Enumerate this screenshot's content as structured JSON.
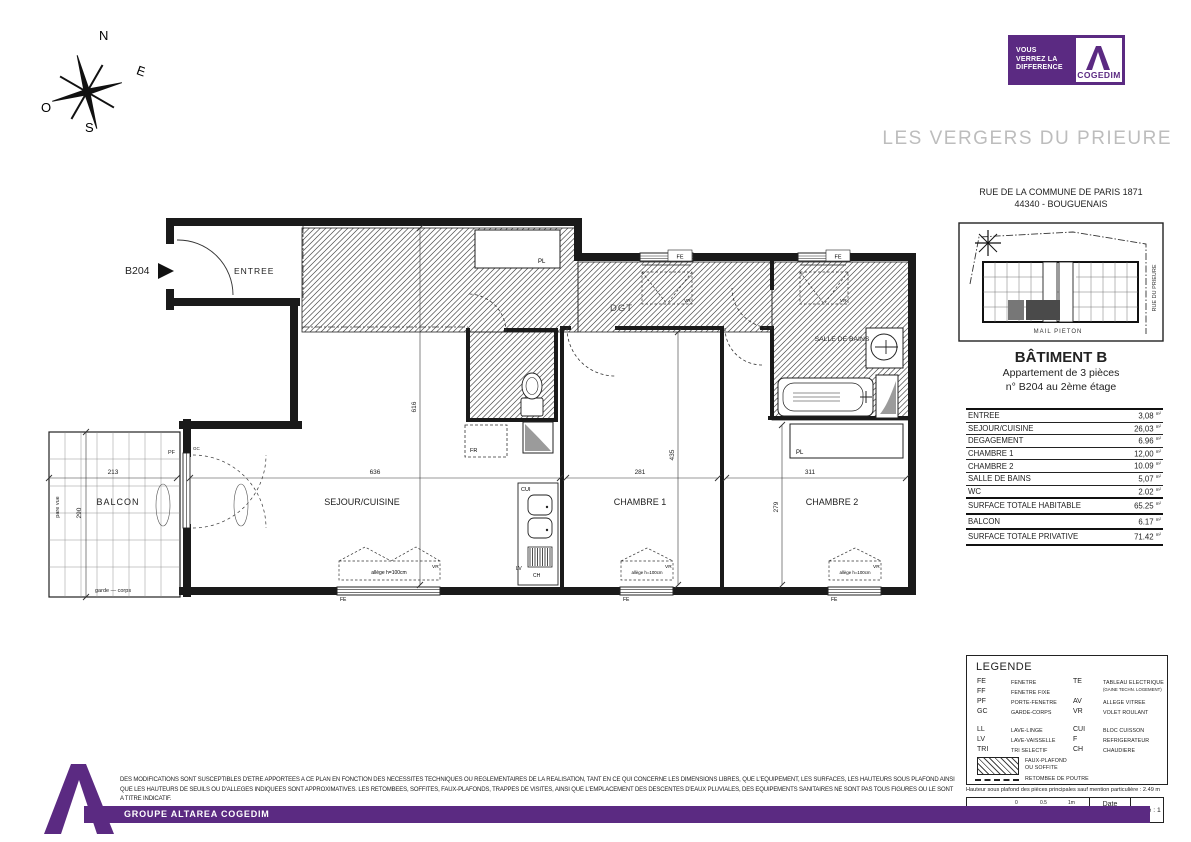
{
  "header": {
    "tagline": [
      "VOUS",
      "VERREZ LA",
      "DIFFERENCE"
    ],
    "brand": "COGEDIM",
    "project_title": "LES VERGERS DU PRIEURE"
  },
  "compass": {
    "n": "N",
    "e": "E",
    "s": "S",
    "w": "O"
  },
  "sidebar": {
    "address1": "RUE DE LA COMMUNE DE PARIS 1871",
    "address2": "44340 - BOUGUENAIS",
    "siteplan": {
      "street_bottom": "MAIL PIETON",
      "street_right": "RUE DU PRIEURE"
    },
    "building": "BÂTIMENT B",
    "apartment_line1": "Appartement de 3 pièces",
    "apartment_line2": "n° B204 au 2ème étage",
    "unit": "m²",
    "surfaces": [
      {
        "label": "ENTREE",
        "value": "3,08"
      },
      {
        "label": "SEJOUR/CUISINE",
        "value": "26,03"
      },
      {
        "label": "DEGAGEMENT",
        "value": "6.96"
      },
      {
        "label": "CHAMBRE 1",
        "value": "12,00"
      },
      {
        "label": "CHAMBRE 2",
        "value": "10.09"
      },
      {
        "label": "SALLE DE BAINS",
        "value": "5,07"
      },
      {
        "label": "WC",
        "value": "2.02"
      },
      {
        "label": "SURFACE TOTALE HABITABLE",
        "value": "65.25"
      },
      {
        "label": "BALCON",
        "value": "6.17"
      },
      {
        "label": "SURFACE TOTALE PRIVATIVE",
        "value": "71.42"
      }
    ]
  },
  "legend": {
    "title": "LEGENDE",
    "col1": [
      {
        "abbr": "FE",
        "term": "FENETRE"
      },
      {
        "abbr": "FF",
        "term": "FENETRE FIXE"
      },
      {
        "abbr": "PF",
        "term": "PORTE-FENETRE"
      },
      {
        "abbr": "GC",
        "term": "GARDE-CORPS"
      },
      {
        "abbr": "LL",
        "term": "LAVE-LINGE"
      },
      {
        "abbr": "LV",
        "term": "LAVE-VAISSELLE"
      },
      {
        "abbr": "TRI",
        "term": "TRI SELECTIF"
      }
    ],
    "col2": [
      {
        "abbr": "TE",
        "term": "TABLEAU ELECTRIQUE",
        "sub": "(GAINE TECHN. LOGEMENT)"
      },
      {
        "abbr": "AV",
        "term": "ALLEGE VITREE"
      },
      {
        "abbr": "VR",
        "term": "VOLET ROULANT"
      },
      {
        "abbr": "CUI",
        "term": "BLOC CUISSON"
      },
      {
        "abbr": "F",
        "term": "REFRIGERATEUR"
      },
      {
        "abbr": "CH",
        "term": "CHAUDIERE"
      }
    ],
    "hatch_label1": "FAUX-PLAFOND",
    "hatch_label2": "OU SOFFITE",
    "dash_label": "RETOMBEE DE POUTRE",
    "note": "Hauteur sous plafond des pièces principales sauf mention particulière : 2.49 m"
  },
  "scalebox": {
    "echelle_label": "Echelle",
    "tick0": "0",
    "tick05": "0.5",
    "tick1": "1m",
    "date_label": "Date",
    "date_value": "29/03/2018",
    "indice": "Indice : 1"
  },
  "plan": {
    "unit_id": "B204",
    "rooms": {
      "entree": "ENTREE",
      "sejour": "SEJOUR/CUISINE",
      "chambre1": "CHAMBRE 1",
      "chambre2": "CHAMBRE 2",
      "balcon": "BALCON",
      "sdb": "SALLE DE BAINS",
      "dgt": "DGT"
    },
    "tags": {
      "pl": "PL",
      "fr": "FR",
      "cui": "CUI",
      "lv": "LV",
      "ch": "CH",
      "vr": "VR",
      "fe": "FE",
      "pf": "PF",
      "gc": "GC"
    },
    "notes": {
      "pare_vue": "pare vue",
      "garde_corps": "garde — corps",
      "allege": "allège h=100cm"
    },
    "dims": {
      "balcon_w": "213",
      "balcon_h": "290",
      "sejour_w": "636",
      "chambre1_w": "281",
      "chambre2_w": "311",
      "left_h": "616",
      "chambre1_h": "435",
      "chambre2_h": "279"
    }
  },
  "footer": {
    "disclaimer1": "DES MODIFICATIONS SONT SUSCEPTIBLES D'ETRE APPORTEES A CE PLAN EN FONCTION DES NECESSITES TECHNIQUES OU REGLEMENTAIRES DE LA REALISATION, TANT EN CE QUI CONCERNE LES DIMENSIONS LIBRES, QUE L'EQUIPEMENT, LES SURFACES, LES HAUTEURS SOUS PLAFOND AINSI",
    "disclaimer2": "QUE LES HAUTEURS DE SEUILS OU D'ALLEGES INDIQUEES SONT APPROXIMATIVES. LES RETOMBEES, SOFFITES, FAUX-PLAFONDS, TRAPPES DE VISITES, AINSI QUE L'EMPLACEMENT DES DESCENTES D'EAUX PLUVIALES, DES EQUIPEMENTS SANITAIRES NE SONT PAS TOUS FIGURES OU LE SONT",
    "disclaimer3": "A TITRE INDICATIF.",
    "band": "GROUPE ALTAREA COGEDIM"
  }
}
